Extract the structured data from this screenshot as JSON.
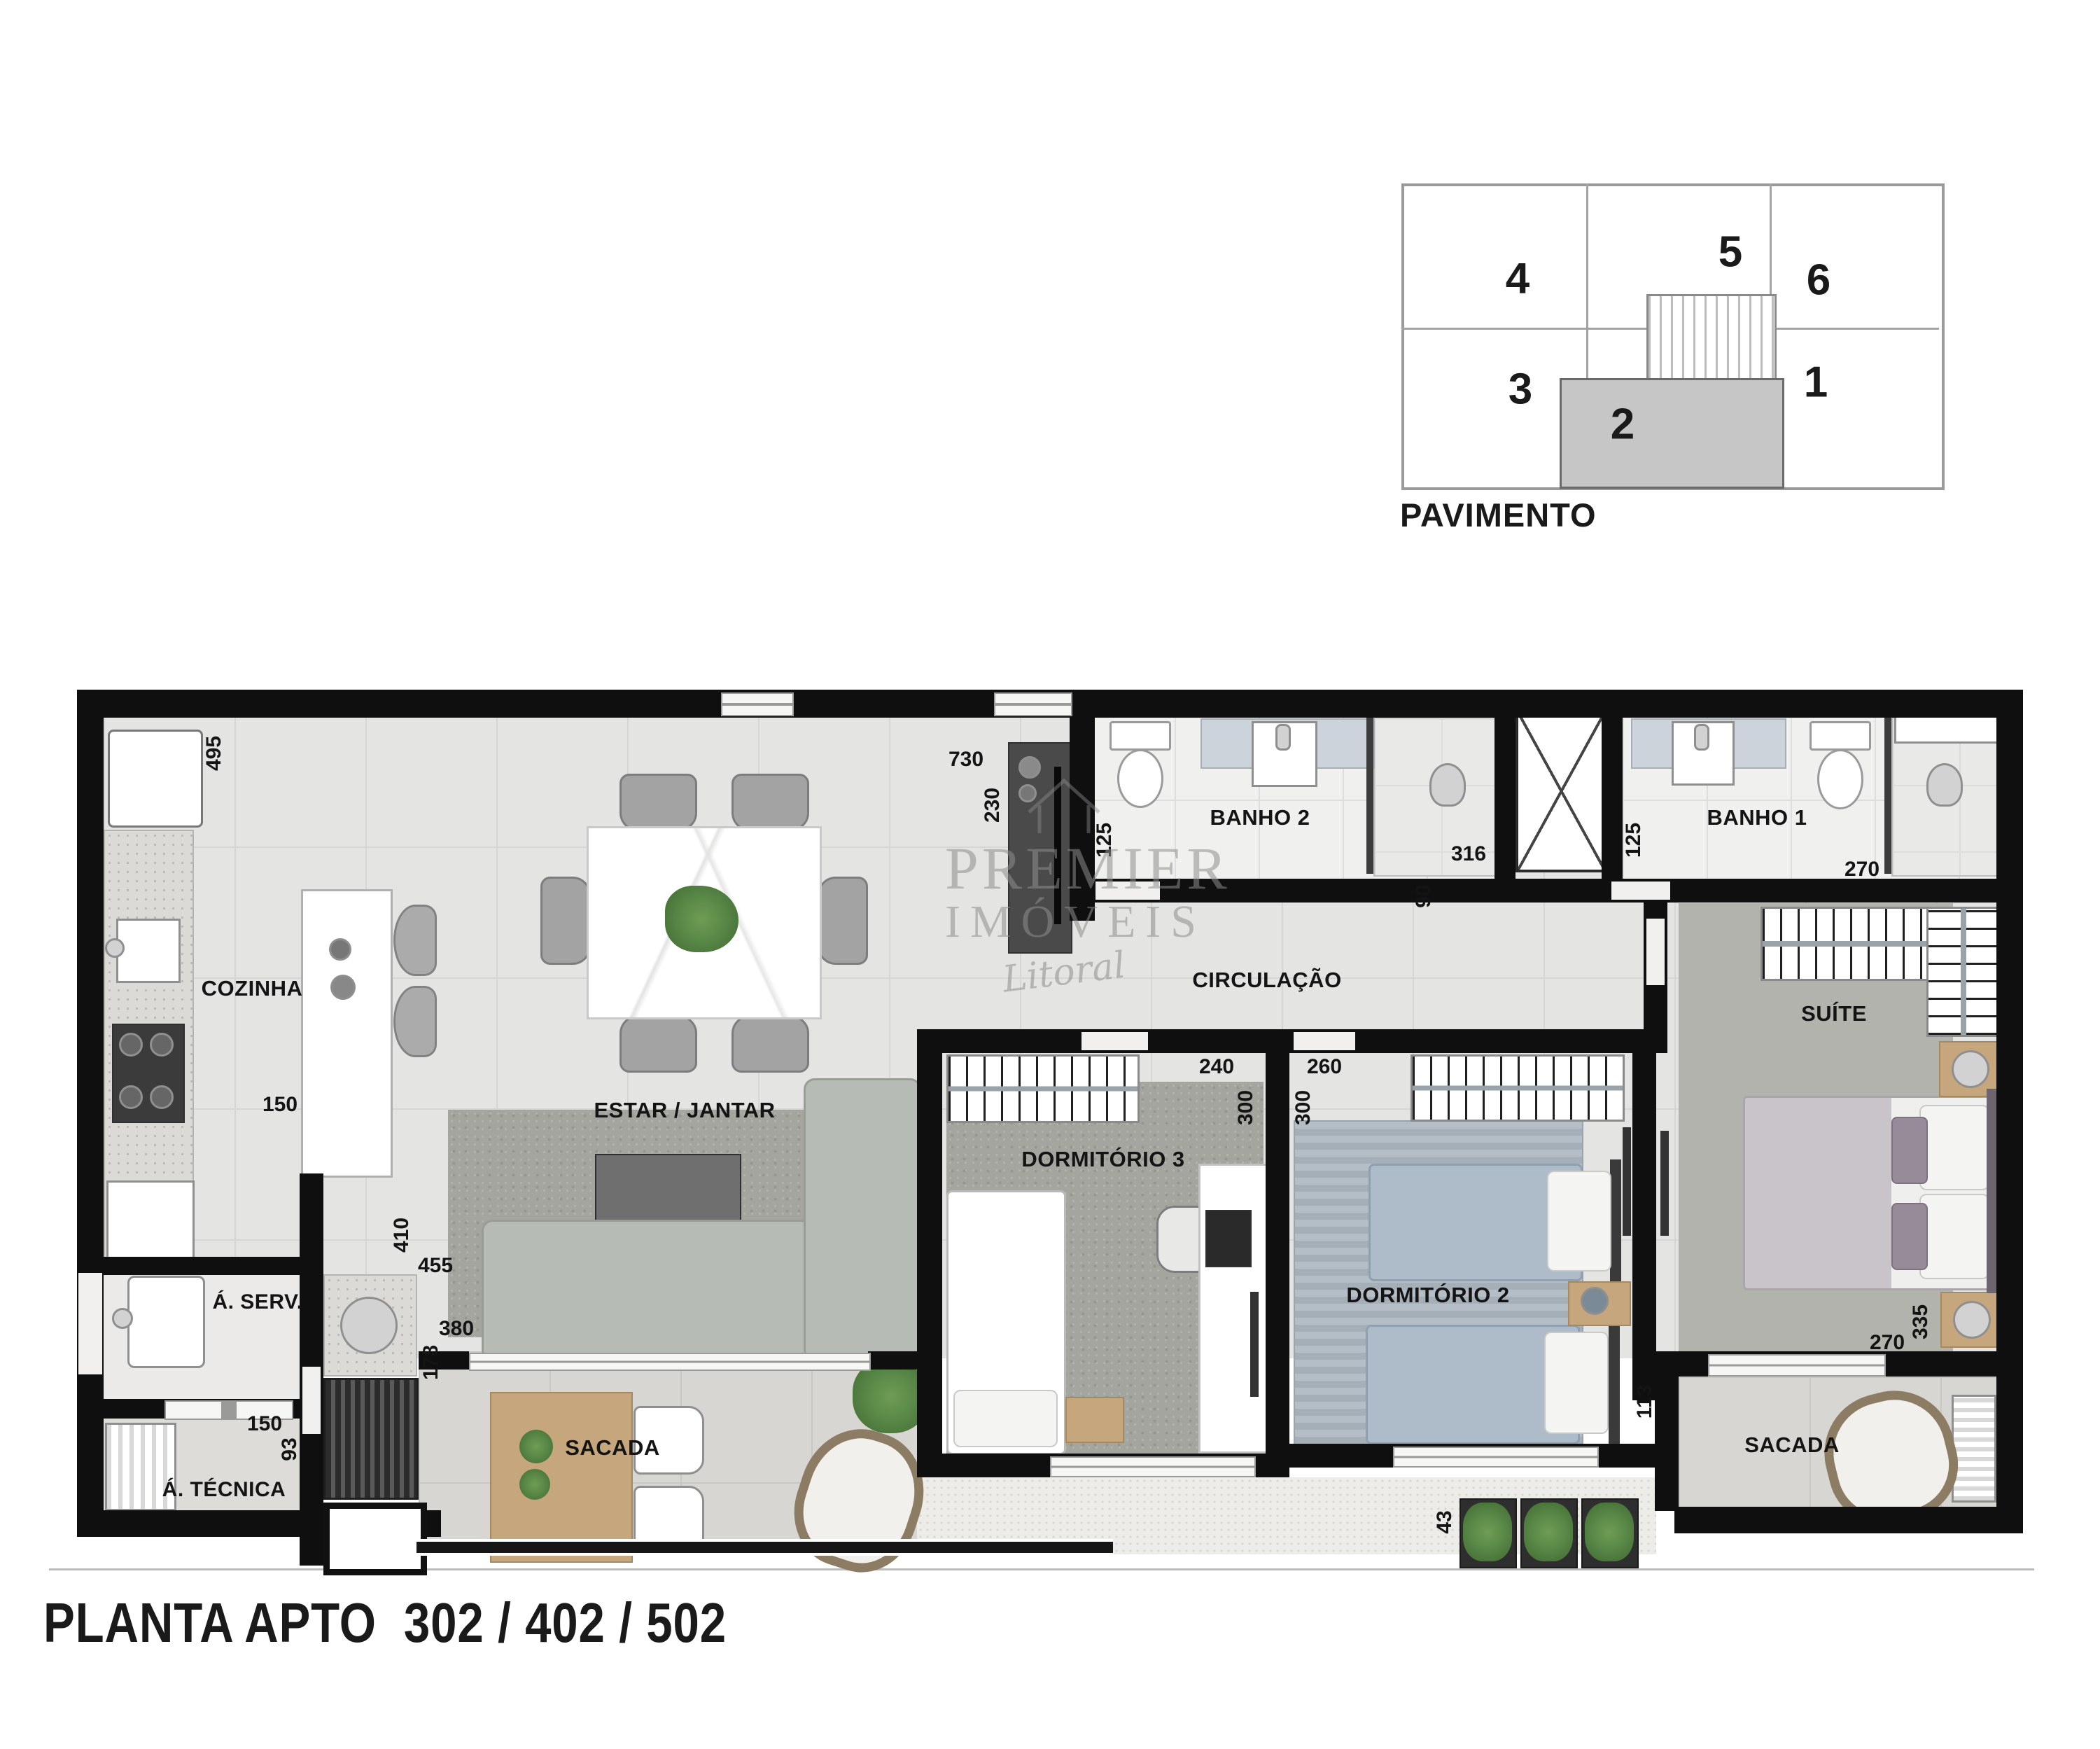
{
  "title": "PLANTA APTO  302 / 402 / 502",
  "key_plan": {
    "caption": "PAVIMENTO",
    "units": [
      {
        "number": "4"
      },
      {
        "number": "5"
      },
      {
        "number": "6"
      },
      {
        "number": "3"
      },
      {
        "number": "2",
        "highlighted": true
      },
      {
        "number": "1"
      }
    ],
    "highlight_color": "#c6c6c6"
  },
  "watermark": {
    "line1": "PREMIER",
    "line2": "IMÓVEIS",
    "line3": "Litoral"
  },
  "rooms": {
    "cozinha": "COZINHA",
    "estar_jantar": "ESTAR / JANTAR",
    "banho2": "BANHO 2",
    "banho1": "BANHO 1",
    "circulacao": "CIRCULAÇÃO",
    "suite": "SUÍTE",
    "dormitorio3": "DORMITÓRIO 3",
    "dormitorio2": "DORMITÓRIO 2",
    "sacada_estar": "SACADA",
    "sacada_suite": "SACADA",
    "area_servico": "Á. SERV.",
    "area_tecnica": "Á. TÉCNICA"
  },
  "dimensions_cm": {
    "geladeira": "495",
    "cozinha_passagem": "150",
    "estar_largura": "730",
    "estar_tv": "230",
    "banho2_acesso": "125",
    "banho2_box": "316",
    "hall_recuo": "90",
    "banho1_acesso": "125",
    "banho1_largura": "270",
    "dorm3_largura": "240",
    "dorm3_fundo": "300",
    "dorm2_largura": "260",
    "dorm2_fundo": "300",
    "suite_fundo": "335",
    "suite_largura": "270",
    "sacada_recuo": "113",
    "sacada_410": "410",
    "sacada_455": "455",
    "sacada_380": "380",
    "sacada_178": "178",
    "servico_150": "150",
    "servico_93": "93",
    "floreira_43": "43"
  },
  "colors": {
    "wall": "#0f0f0f",
    "floor": "#e4e4e2",
    "accent_green": "#558344"
  }
}
